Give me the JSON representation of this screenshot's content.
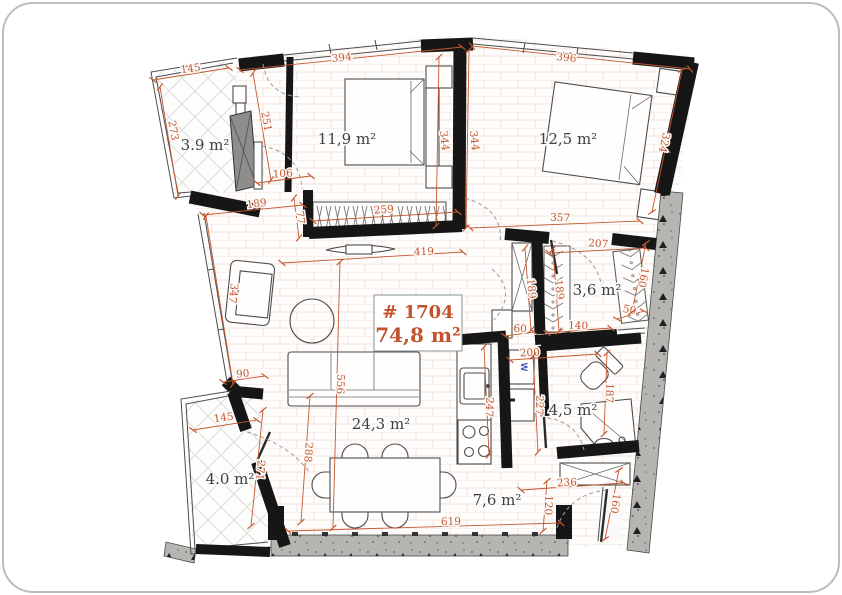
{
  "unit": {
    "number_label": "# 1704",
    "area_label": "74,8 m²"
  },
  "rooms": [
    {
      "name": "balcony-upper",
      "area": "3.9 m²"
    },
    {
      "name": "bedroom-1",
      "area": "11,9 m²"
    },
    {
      "name": "bedroom-2",
      "area": "12,5 m²"
    },
    {
      "name": "wardrobe-room",
      "area": "3,6 m²"
    },
    {
      "name": "living-dining",
      "area": "24,3 m²"
    },
    {
      "name": "bathroom",
      "area": "4,5 m²"
    },
    {
      "name": "hall-kitchen",
      "area": "7,6 m²"
    },
    {
      "name": "balcony-lower",
      "area": "4.0 m²"
    }
  ],
  "dimensions_cm": [
    "145",
    "273",
    "251",
    "394",
    "396",
    "106",
    "189",
    "77",
    "259",
    "344",
    "344",
    "324",
    "357",
    "419",
    "207",
    "189",
    "189",
    "160",
    "50",
    "140",
    "60",
    "347",
    "90",
    "556",
    "288",
    "145",
    "271",
    "247",
    "227",
    "200",
    "187",
    "236",
    "120",
    "160",
    "619"
  ],
  "labels": {
    "washer": "W"
  },
  "colors": {
    "dimension_text": "#c6572e",
    "room_text": "#3c4148",
    "unit_text": "#c2532c",
    "wall": "#161616",
    "concrete_wall": "#b7b5b2",
    "washer_text": "#3f51c1"
  }
}
